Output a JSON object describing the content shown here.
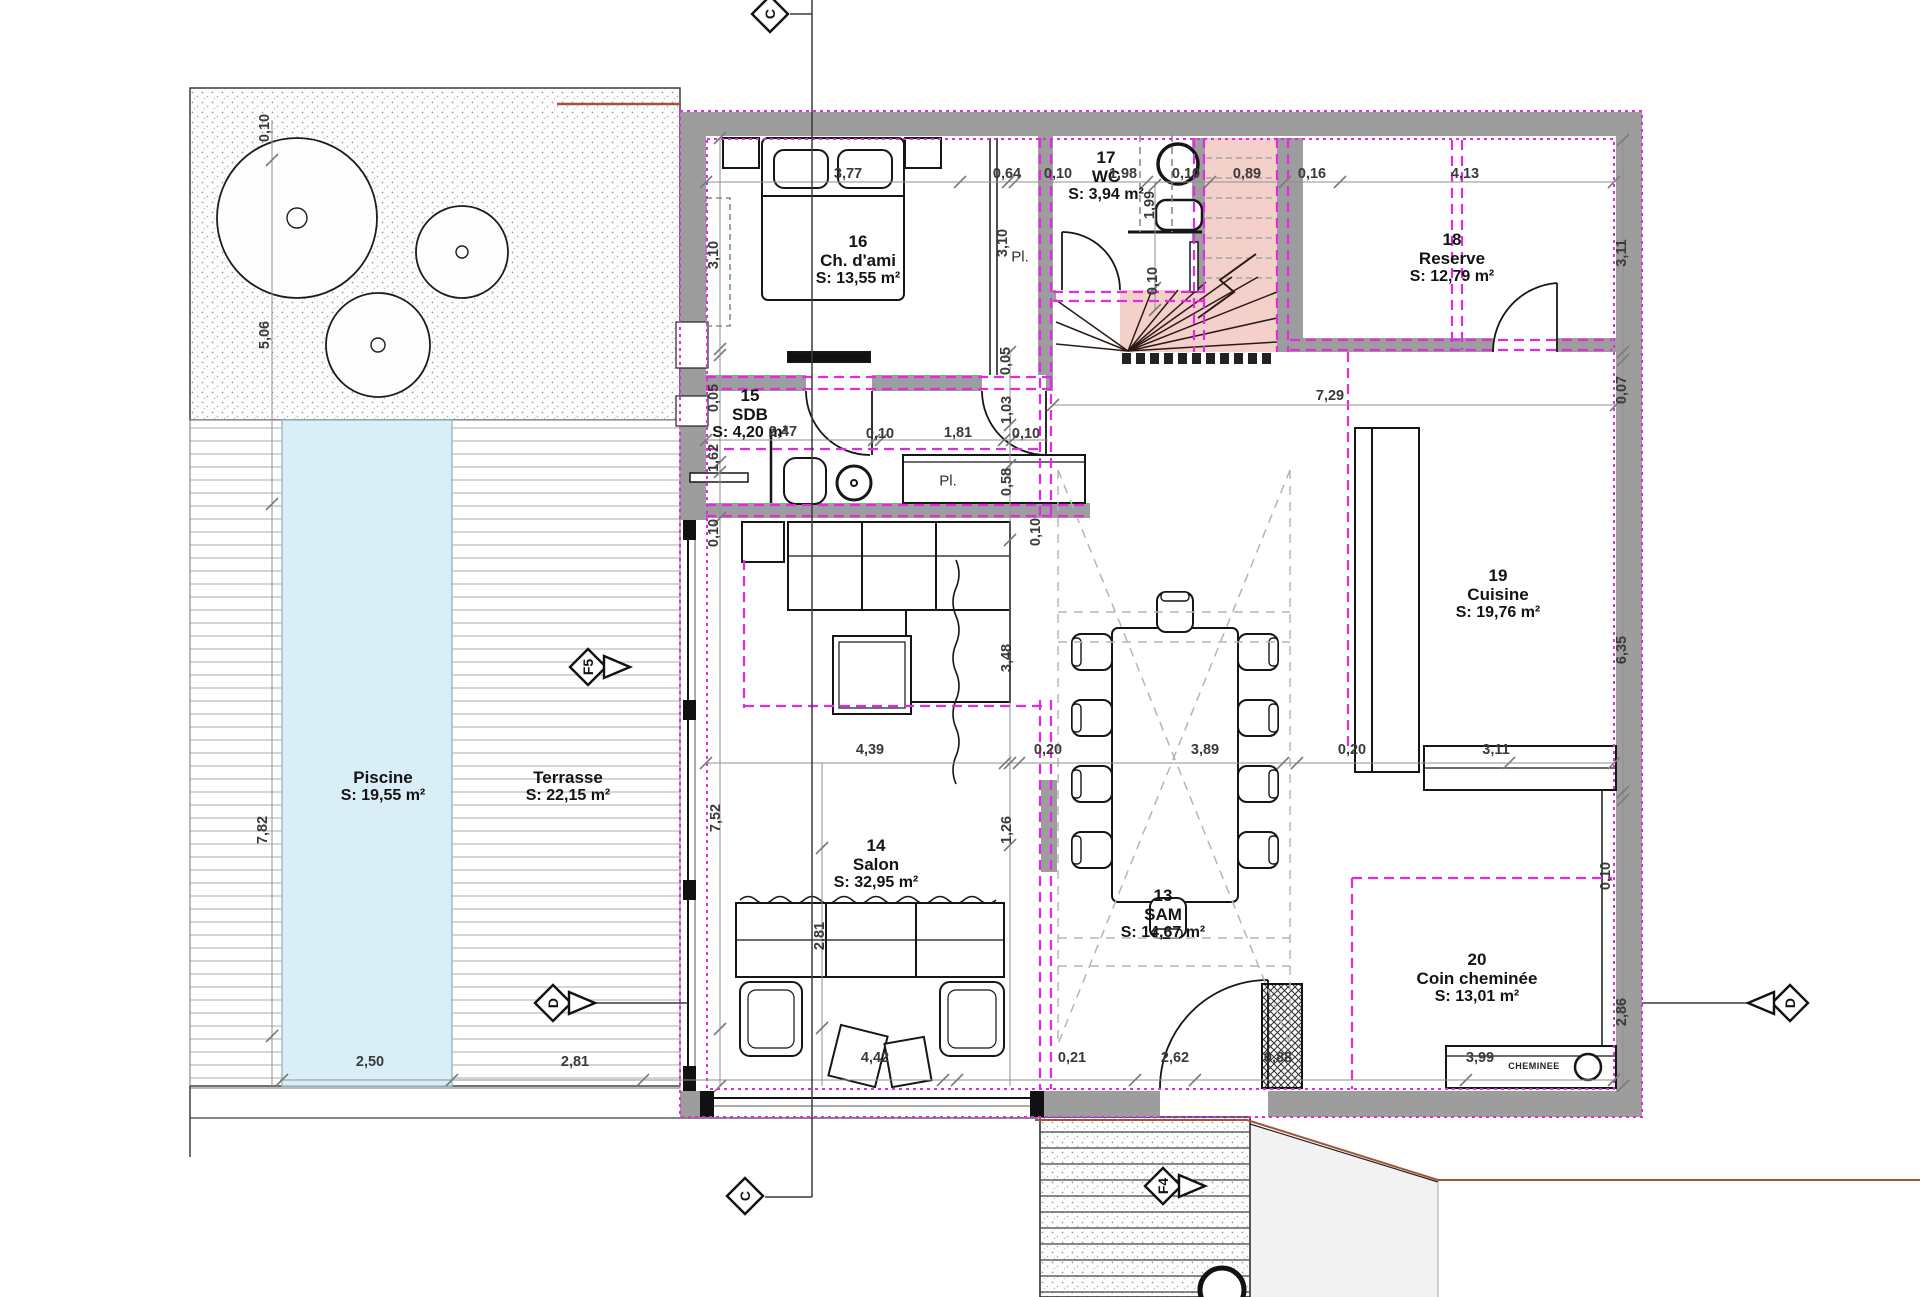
{
  "colors": {
    "wall_gray": "#9d9d9d",
    "magenta": "#e32ae3",
    "stair_pink": "#f4d0cb",
    "pool_blue": "#daeef7",
    "dim_gray": "#8f8f8f",
    "red_boundary": "#a2543a",
    "text": "#141414"
  },
  "rooms": [
    {
      "num": "16",
      "name": "Ch. d'ami",
      "area": "S: 13,55 m²",
      "x": 858,
      "y": 232
    },
    {
      "num": "15",
      "name": "SDB",
      "area": "S: 4,20 m²",
      "x": 750,
      "y": 386
    },
    {
      "num": "17",
      "name": "WC",
      "area": "S: 3,94 m²",
      "x": 1106,
      "y": 148
    },
    {
      "num": "18",
      "name": "Reserve",
      "area": "S: 12,79 m²",
      "x": 1452,
      "y": 230
    },
    {
      "num": "19",
      "name": "Cuisine",
      "area": "S: 19,76 m²",
      "x": 1498,
      "y": 566
    },
    {
      "num": "13",
      "name": "SAM",
      "area": "S: 14,67 m²",
      "x": 1163,
      "y": 886
    },
    {
      "num": "14",
      "name": "Salon",
      "area": "S: 32,95 m²",
      "x": 876,
      "y": 836
    },
    {
      "num": "20",
      "name": "Coin cheminée",
      "area": "S: 13,01 m²",
      "x": 1477,
      "y": 950
    },
    {
      "num": "",
      "name": "Piscine",
      "area": "S: 19,55 m²",
      "x": 383,
      "y": 768
    },
    {
      "num": "",
      "name": "Terrasse",
      "area": "S: 22,15 m²",
      "x": 568,
      "y": 768
    }
  ],
  "dims_h": [
    {
      "t": "3,77",
      "x": 848,
      "y": 174
    },
    {
      "t": "0,64",
      "x": 1007,
      "y": 174
    },
    {
      "t": "0,10",
      "x": 1058,
      "y": 174
    },
    {
      "t": "1,98",
      "x": 1123,
      "y": 174
    },
    {
      "t": "0,10",
      "x": 1186,
      "y": 174
    },
    {
      "t": "0,89",
      "x": 1247,
      "y": 174
    },
    {
      "t": "0,16",
      "x": 1312,
      "y": 174
    },
    {
      "t": "4,13",
      "x": 1465,
      "y": 174
    },
    {
      "t": "2,47",
      "x": 783,
      "y": 432
    },
    {
      "t": "0,10",
      "x": 880,
      "y": 434
    },
    {
      "t": "1,81",
      "x": 958,
      "y": 433
    },
    {
      "t": "0,10",
      "x": 1026,
      "y": 434
    },
    {
      "t": "7,29",
      "x": 1330,
      "y": 396
    },
    {
      "t": "4,39",
      "x": 870,
      "y": 750
    },
    {
      "t": "0,20",
      "x": 1048,
      "y": 750
    },
    {
      "t": "3,89",
      "x": 1205,
      "y": 750
    },
    {
      "t": "0,20",
      "x": 1352,
      "y": 750
    },
    {
      "t": "3,11",
      "x": 1496,
      "y": 750
    },
    {
      "t": "2,50",
      "x": 370,
      "y": 1062
    },
    {
      "t": "2,81",
      "x": 575,
      "y": 1062
    },
    {
      "t": "4,42",
      "x": 875,
      "y": 1058
    },
    {
      "t": "0,21",
      "x": 1072,
      "y": 1058
    },
    {
      "t": "2,62",
      "x": 1175,
      "y": 1058
    },
    {
      "t": "0,88",
      "x": 1278,
      "y": 1058
    },
    {
      "t": "3,99",
      "x": 1480,
      "y": 1058
    }
  ],
  "dims_v": [
    {
      "t": "0,10",
      "x": 265,
      "y": 128
    },
    {
      "t": "5,06",
      "x": 265,
      "y": 335
    },
    {
      "t": "7,82",
      "x": 263,
      "y": 830
    },
    {
      "t": "3,10",
      "x": 714,
      "y": 255
    },
    {
      "t": "0,05",
      "x": 714,
      "y": 398
    },
    {
      "t": "1,62",
      "x": 714,
      "y": 458
    },
    {
      "t": "0,10",
      "x": 714,
      "y": 533
    },
    {
      "t": "7,52",
      "x": 716,
      "y": 818
    },
    {
      "t": "3,10",
      "x": 1003,
      "y": 243
    },
    {
      "t": "0,05",
      "x": 1006,
      "y": 361
    },
    {
      "t": "1,99",
      "x": 1150,
      "y": 205
    },
    {
      "t": "0,10",
      "x": 1153,
      "y": 281
    },
    {
      "t": "1,03",
      "x": 1007,
      "y": 410
    },
    {
      "t": "0,58",
      "x": 1007,
      "y": 482
    },
    {
      "t": "0,10",
      "x": 1036,
      "y": 532
    },
    {
      "t": "3,48",
      "x": 1007,
      "y": 658
    },
    {
      "t": "1,26",
      "x": 1007,
      "y": 830
    },
    {
      "t": "2,81",
      "x": 820,
      "y": 936
    },
    {
      "t": "3,11",
      "x": 1622,
      "y": 253
    },
    {
      "t": "0,07",
      "x": 1622,
      "y": 390
    },
    {
      "t": "6,35",
      "x": 1622,
      "y": 650
    },
    {
      "t": "0,10",
      "x": 1606,
      "y": 876
    },
    {
      "t": "2,86",
      "x": 1622,
      "y": 1012
    }
  ],
  "texts": [
    {
      "t": "Pl.",
      "x": 1020,
      "y": 257,
      "cls": ""
    },
    {
      "t": "Pl.",
      "x": 948,
      "y": 481,
      "cls": ""
    },
    {
      "t": "CHEMINEE",
      "x": 1534,
      "y": 1066,
      "cls": "small"
    }
  ],
  "markers": [
    {
      "label": "C",
      "x": 770,
      "y": 14,
      "arrow": "none"
    },
    {
      "label": "C",
      "x": 745,
      "y": 1196,
      "arrow": "none"
    },
    {
      "label": "D",
      "x": 553,
      "y": 1003,
      "arrow": "right"
    },
    {
      "label": "D",
      "x": 1790,
      "y": 1003,
      "arrow": "left"
    },
    {
      "label": "F5",
      "x": 588,
      "y": 667,
      "arrow": "right"
    },
    {
      "label": "F4",
      "x": 1163,
      "y": 1186,
      "arrow": "right"
    }
  ]
}
